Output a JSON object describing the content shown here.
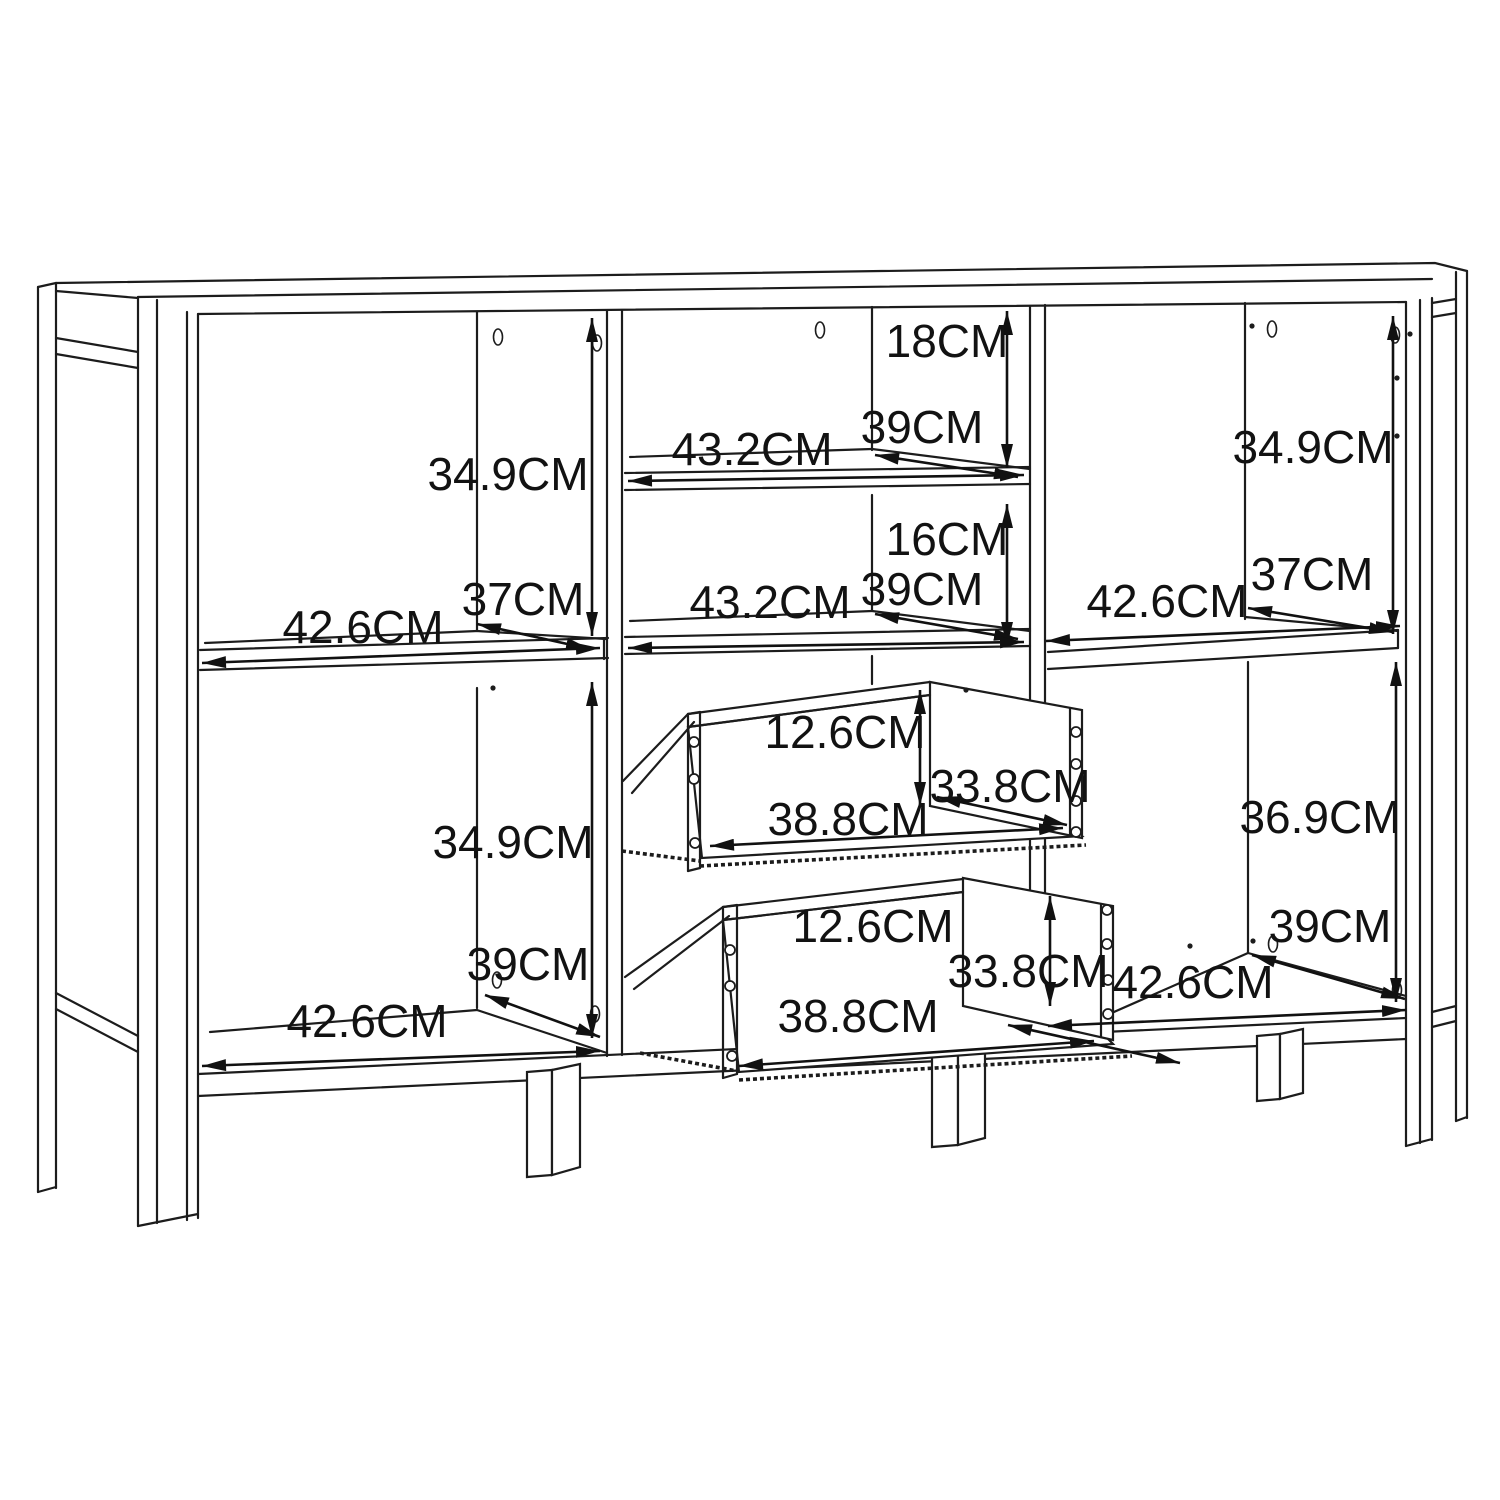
{
  "figure": {
    "subject": "cabinet-dimension-diagram",
    "unit": "CM",
    "line_color": "#1c1c1c",
    "background_color": "#ffffff"
  },
  "dimensions": {
    "left_top": {
      "height": "34.9CM",
      "depth": "37CM",
      "width": "42.6CM"
    },
    "left_bottom": {
      "height": "34.9CM",
      "depth": "39CM",
      "width": "42.6CM"
    },
    "middle_shelf_top": {
      "height": "18CM",
      "depth": "39CM",
      "width": "43.2CM"
    },
    "middle_shelf_bottom": {
      "height": "16CM",
      "depth": "39CM",
      "width": "43.2CM"
    },
    "drawer_top": {
      "height": "12.6CM",
      "depth": "33.8CM",
      "width": "38.8CM"
    },
    "drawer_bottom": {
      "height": "12.6CM",
      "depth": "33.8CM",
      "width": "38.8CM"
    },
    "right_top": {
      "height": "34.9CM",
      "depth": "37CM",
      "width": "42.6CM"
    },
    "right_bottom": {
      "height": "36.9CM",
      "depth": "39CM",
      "width": "42.6CM"
    }
  }
}
